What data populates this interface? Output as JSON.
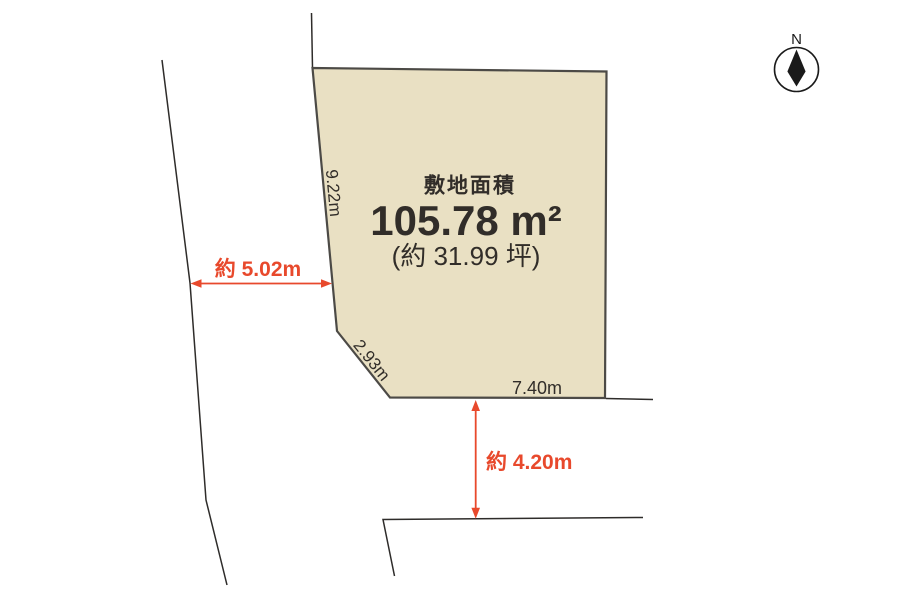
{
  "plot": {
    "area_label": "敷地面積",
    "area_value": "105.78 m²",
    "area_tsubo": "(約 31.99 坪)",
    "edge_labels": {
      "left": "9.22m",
      "corner": "2.93m",
      "bottom": "7.40m"
    },
    "fill_color": "#e9e0c3",
    "border_color": "#4c4a46"
  },
  "dimensions": {
    "left_road_width": "約 5.02m",
    "bottom_road_width": "約 4.20m",
    "arrow_color": "#e8492c"
  },
  "compass": {
    "north_label": "N"
  },
  "colors": {
    "road_line": "#2e2c2a",
    "text": "#312d29",
    "background": "#ffffff"
  }
}
